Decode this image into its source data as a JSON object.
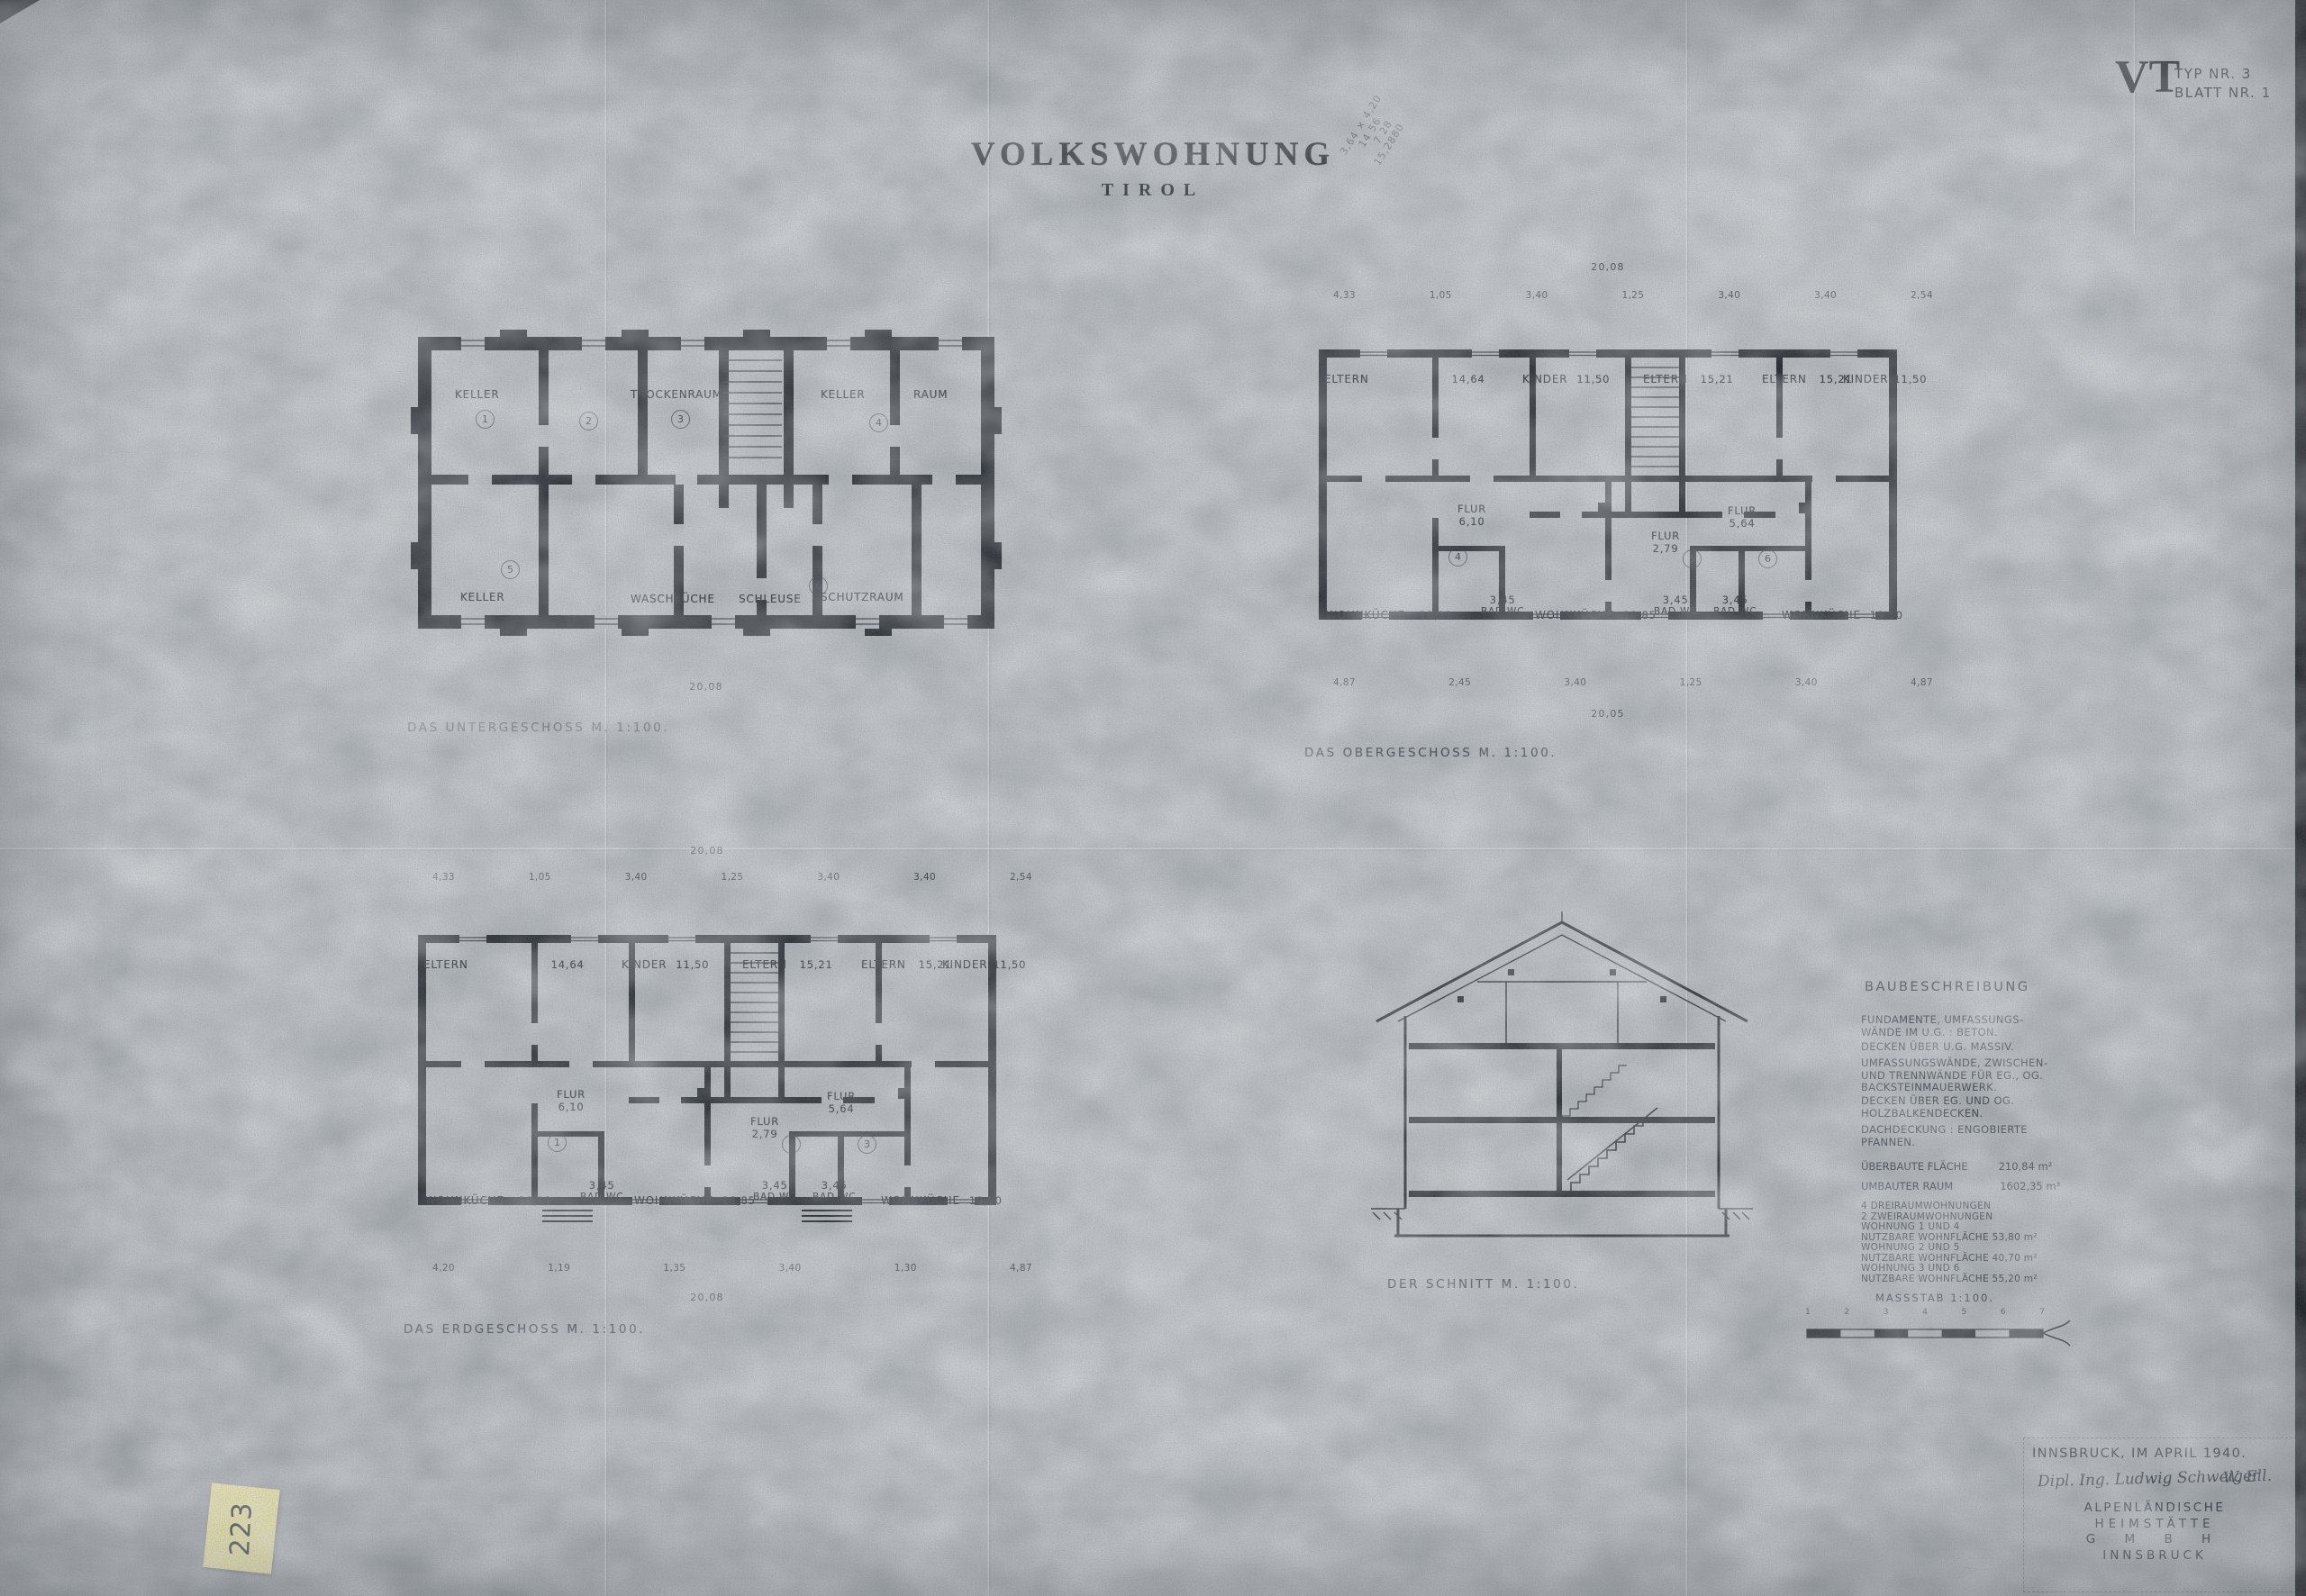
{
  "page": {
    "title": "VOLKSWOHNUNG",
    "subtitle": "TIROL",
    "sheet_code": "VT",
    "sheet_type_label": "TYP NR. 3",
    "sheet_number_label": "BLATT NR. 1"
  },
  "pencil_note": {
    "lines": [
      "3,64 × 4,20",
      "14 56",
      "7 28",
      "15,2880"
    ]
  },
  "sticky_note": {
    "text": "223"
  },
  "plans": {
    "untergeschoss": {
      "caption": "DAS UNTERGESCHOSS   M. 1:100.",
      "rooms_top": [
        "KELLER",
        "TROCKENRAUM",
        "KELLER",
        "RAUM"
      ],
      "rooms_bottom": [
        "KELLER",
        "WASCHKÜCHE",
        "SCHLEUSE",
        "SCHUTZRAUM"
      ],
      "unit_numbers": [
        "1",
        "2",
        "3",
        "4",
        "5",
        "6"
      ],
      "dim_total_bottom": "20,08"
    },
    "obergeschoss": {
      "caption": "DAS OBERGESCHOSS   M. 1:100.",
      "dim_total_top": "20,08",
      "dims_top": [
        "4,33",
        "1,05",
        "3,40",
        "1,25",
        "3,40",
        "3,40",
        "2,54"
      ],
      "dims_bottom": [
        "4,87",
        "2,45",
        "3,40",
        "1,25",
        "3,40",
        "4,87"
      ],
      "dim_total_bottom": "20,05",
      "rooms_top": [
        {
          "name": "ELTERN",
          "area": "14,64"
        },
        {
          "name": "KINDER",
          "area": "11,50"
        },
        {
          "name": "ELTERN",
          "area": "15,21"
        },
        {
          "name": "ELTERN",
          "area": "15,21"
        },
        {
          "name": "KINDER",
          "area": "11,50"
        }
      ],
      "halls": [
        {
          "name": "FLUR",
          "area": "6,10"
        },
        {
          "name": "FLUR",
          "area": "2,79"
        },
        {
          "name": "FLUR",
          "area": "5,64"
        }
      ],
      "rooms_bottom": [
        {
          "name": "WOHNKÜCHE",
          "area": "18,11"
        },
        {
          "name": "BAD WC",
          "area": "3,45"
        },
        {
          "name": "WOHNKÜCHE",
          "area": "18,85"
        },
        {
          "name": "BAD WC",
          "area": "3,45"
        },
        {
          "name": "BAD WC",
          "area": "3,45"
        },
        {
          "name": "WOHNKÜCHE",
          "area": "19,50"
        }
      ],
      "unit_numbers": [
        "4",
        "5",
        "6"
      ]
    },
    "erdgeschoss": {
      "caption": "DAS ERDGESCHOSS   M. 1:100.",
      "dim_total_top": "20,08",
      "dims_top": [
        "4,33",
        "1,05",
        "3,40",
        "1,25",
        "3,40",
        "3,40",
        "2,54"
      ],
      "dims_bottom": [
        "4,20",
        "1,19",
        "1,35",
        "3,40",
        "1,30",
        "4,87"
      ],
      "dim_total_bottom": "20,08",
      "rooms_top": [
        {
          "name": "ELTERN",
          "area": "14,64"
        },
        {
          "name": "KINDER",
          "area": "11,50"
        },
        {
          "name": "ELTERN",
          "area": "15,21"
        },
        {
          "name": "ELTERN",
          "area": "15,21"
        },
        {
          "name": "KINDER",
          "area": "11,50"
        }
      ],
      "halls": [
        {
          "name": "FLUR",
          "area": "6,10"
        },
        {
          "name": "FLUR",
          "area": "2,79"
        },
        {
          "name": "FLUR",
          "area": "5,64"
        }
      ],
      "rooms_bottom": [
        {
          "name": "WOHNKÜCHE",
          "area": "18,11"
        },
        {
          "name": "BAD WC",
          "area": "3,45"
        },
        {
          "name": "WOHNKÜCHE",
          "area": "18,85"
        },
        {
          "name": "BAD WC",
          "area": "3,45"
        },
        {
          "name": "BAD WC",
          "area": "3,45"
        },
        {
          "name": "WOHNKÜCHE",
          "area": "19,50"
        }
      ],
      "unit_numbers": [
        "1",
        "2",
        "3"
      ]
    },
    "schnitt": {
      "caption": "DER SCHNITT   M. 1:100."
    }
  },
  "baubeschreibung": {
    "title": "BAUBESCHREIBUNG",
    "items": [
      "FUNDAMENTE, UMFASSUNGS-\nWÄNDE IM U.G. : BETON.",
      "DECKEN ÜBER U.G. MASSIV.",
      "UMFASSUNGSWÄNDE, ZWISCHEN-\nUND TRENNWÄNDE FÜR EG., OG.\nBACKSTEINMAUERWERK.",
      "DECKEN ÜBER EG. UND OG.\nHOLZBALKENDECKEN.",
      "DACHDECKUNG : ENGOBIERTE\nPFANNEN."
    ],
    "flaeche_label": "ÜBERBAUTE FLÄCHE",
    "flaeche_value": "210,84 m²",
    "raum_label": "UMBAUTER RAUM",
    "raum_value": "1602,35 m³",
    "apartment_lines": [
      "4 DREIRAUMWOHNUNGEN",
      "2 ZWEIRAUMWOHNUNGEN",
      "WOHNUNG 1 UND 4",
      "NUTZBARE WOHNFLÄCHE  53,80 m²",
      "WOHNUNG 2 UND 5",
      "NUTZBARE WOHNFLÄCHE  40,70 m²",
      "WOHNUNG 3 UND 6",
      "NUTZBARE WOHNFLÄCHE  55,20 m²"
    ],
    "massstab": "MASSSTAB 1:100.",
    "scale_ticks": [
      "1",
      "2",
      "3",
      "4",
      "5",
      "6",
      "7"
    ]
  },
  "title_block": {
    "date_line": "INNSBRUCK, IM APRIL 1940.",
    "signature": "Dipl. Ing. Ludwig Schweiger",
    "signature2": "W. Ell.",
    "company_lines": [
      "ALPENLÄNDISCHE",
      "HEIMSTÄTTE",
      "G M B H",
      "INNSBRUCK"
    ]
  },
  "colors": {
    "paper": "#aeb3b7",
    "ink": "#1c2127",
    "faded_ink": "#3e4650",
    "sticky_note": "#ebe3a0"
  }
}
